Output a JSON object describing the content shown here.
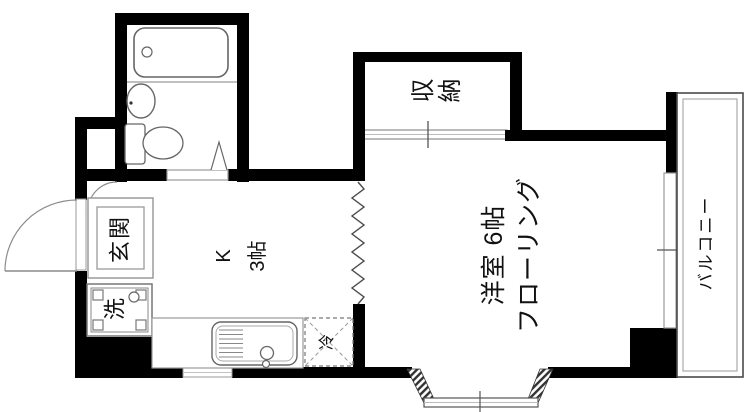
{
  "colors": {
    "wall": "#000000",
    "background": "#ffffff",
    "thin_line": "#8c8c8c",
    "fixture_outline": "#666666",
    "text": "#111111"
  },
  "labels": {
    "storage": "収納",
    "western_room_line1": "洋室 6帖",
    "western_room_line2": "フローリング",
    "kitchen_line1": "K",
    "kitchen_line2": "3帖",
    "entrance": "玄関",
    "laundry": "洗",
    "refrigerator": "冷",
    "balcony": "バルコニー"
  },
  "fixtures": [
    "bathtub-icon",
    "washbasin-icon",
    "toilet-icon",
    "bathroom-folding-door-icon",
    "entrance-door-swing-icon",
    "interior-door-swing-icon",
    "genkan-step-icon",
    "washing-machine-pan-icon",
    "kitchen-counter-icon",
    "kitchen-sink-icon",
    "refrigerator-space-icon",
    "closet-sliding-door-icon",
    "balcony-window-icon",
    "bay-window-icon",
    "vent-window-icon",
    "partition-zigzag-icon"
  ]
}
